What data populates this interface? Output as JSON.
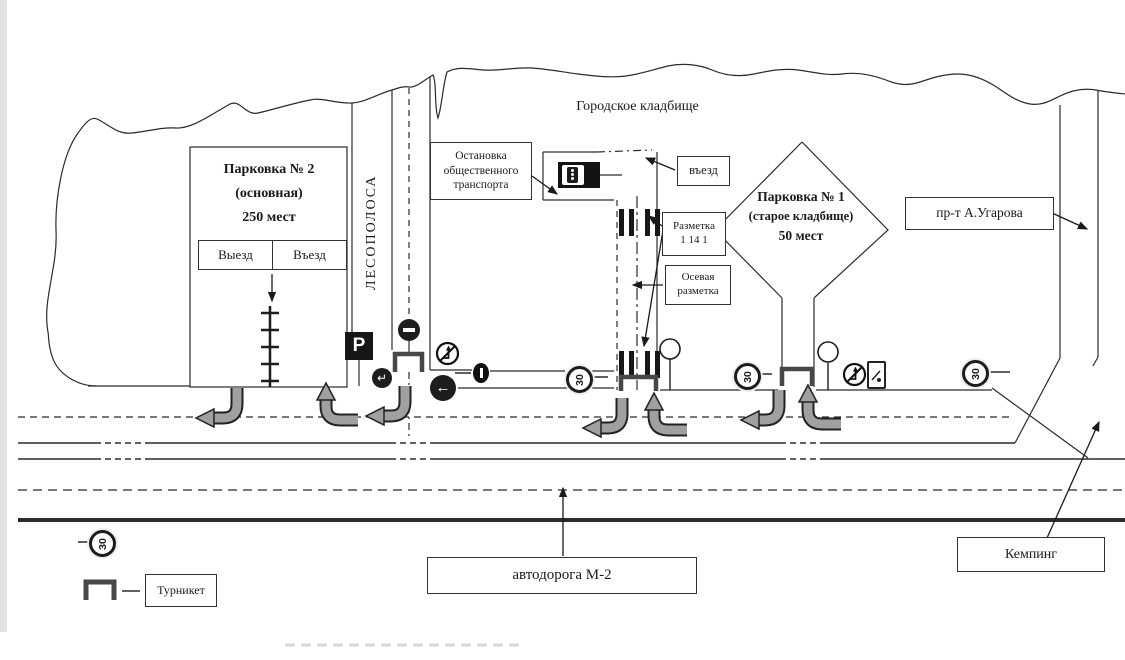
{
  "title": {
    "cemetery": "Городское кладбище"
  },
  "parking2": {
    "name": "Парковка № 2",
    "kind": "(основная)",
    "capacity": "250 мест",
    "exit": "Выезд",
    "entry": "Въезд"
  },
  "parking1": {
    "name": "Парковка № 1",
    "kind": "(старое кладбище)",
    "capacity": "50 мест"
  },
  "labels": {
    "forest_belt": "ЛЕСОПОЛОСА",
    "bus_stop": [
      "Остановка",
      "общественного",
      "транспорта"
    ],
    "entrance": "въезд",
    "marking": [
      "Разметка",
      "1 14 1"
    ],
    "axial_marking": [
      "Осевая",
      "разметка"
    ],
    "avenue": "пр-т А.Угарова",
    "highway": "автодорога М-2",
    "camping": "Кемпинг"
  },
  "legend": {
    "turnstile": "Турникет"
  },
  "signs": {
    "parking_symbol": "P",
    "speed_limit": "30",
    "left_arrow_glyph": "←",
    "turn_glyph": "↵"
  },
  "colors": {
    "line": "#2b2b2b",
    "arrow_fill": "#a0a0a0",
    "sign_dark": "#1d1d1d"
  }
}
